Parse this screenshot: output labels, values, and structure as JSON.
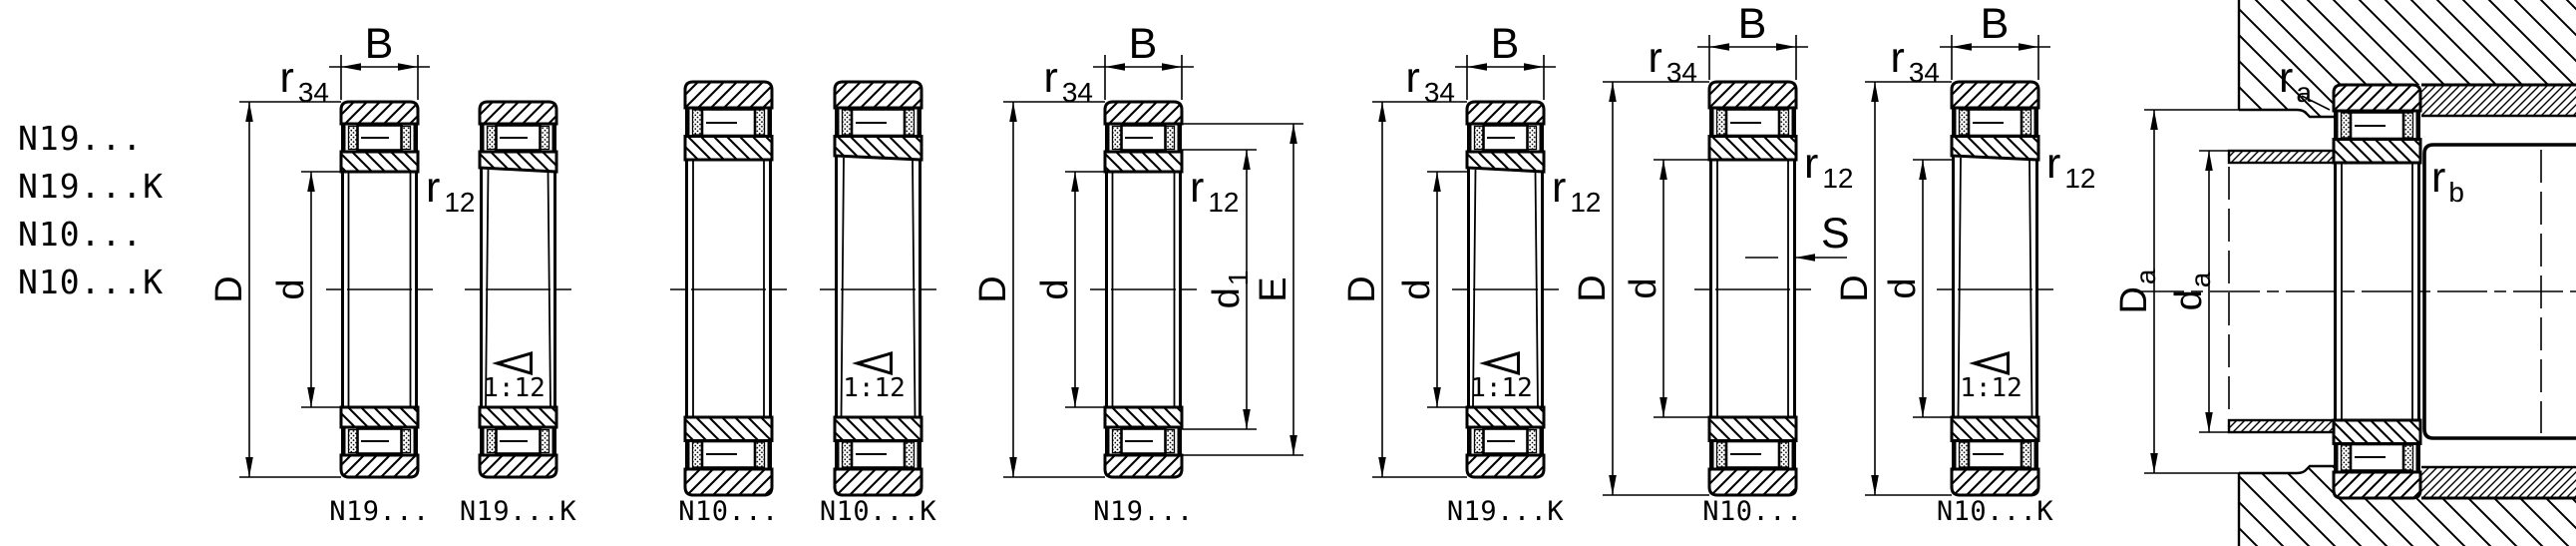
{
  "series_list": [
    "N19...",
    "N19...K",
    "N10...",
    "N10...K"
  ],
  "captions": [
    "N19...",
    "N19...K",
    "N10...",
    "N10...K",
    "N19...",
    "N19...K",
    "N10...",
    "N10...K"
  ],
  "labels": {
    "radius": "r",
    "sub_34": "34",
    "sub_12": "12",
    "width_b": "B",
    "outer_diameter": "D",
    "bore_diameter": "d",
    "d1_base": "d",
    "d1_sub": "1",
    "shoulder_e": "E",
    "wall_s": "S",
    "taper_ratio": "1:12",
    "ra_base": "r",
    "ra_sub": "a",
    "rb_base": "r",
    "rb_sub": "b",
    "housing_dia_base": "D",
    "housing_dia_sub": "a",
    "shaft_dia_base": "d",
    "shaft_dia_sub": "a"
  }
}
